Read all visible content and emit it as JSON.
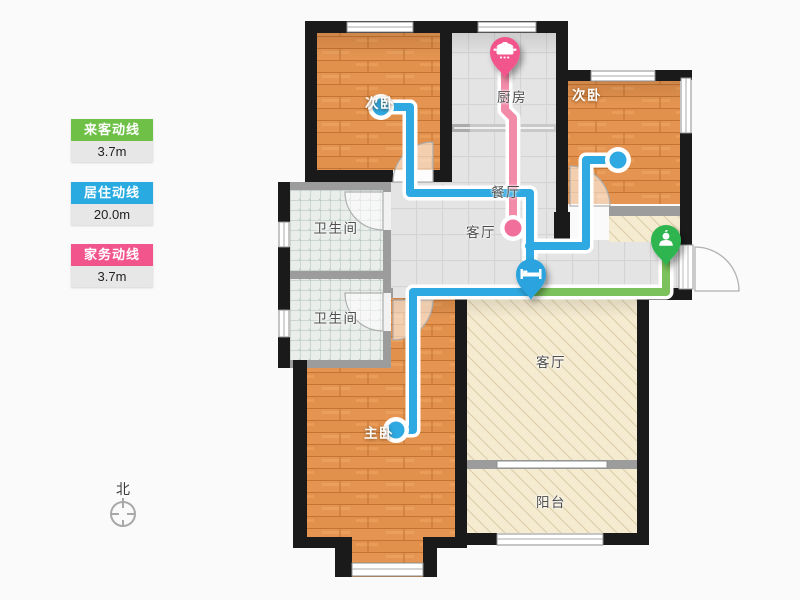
{
  "legend": {
    "items": [
      {
        "label": "来客动线",
        "value": "3.7m",
        "color": "#6EC047"
      },
      {
        "label": "居住动线",
        "value": "20.0m",
        "color": "#29ABE2"
      },
      {
        "label": "家务动线",
        "value": "3.7m",
        "color": "#F2548C"
      }
    ]
  },
  "compass": {
    "label": "北"
  },
  "floorplan": {
    "rooms": [
      {
        "name": "次卧"
      },
      {
        "name": "厨房"
      },
      {
        "name": "次卧"
      },
      {
        "name": "餐厅"
      },
      {
        "name": "客厅"
      },
      {
        "name": "卫生间"
      },
      {
        "name": "卫生间"
      },
      {
        "name": "主卧"
      },
      {
        "name": "客厅"
      },
      {
        "name": "阳台"
      }
    ],
    "lines": {
      "visitor": {
        "label": "来客动线",
        "length": "3.7m",
        "color": "#7BC25C"
      },
      "living": {
        "label": "居住动线",
        "length": "20.0m",
        "color": "#2FA9E1"
      },
      "housework": {
        "label": "家务动线",
        "length": "3.7m",
        "color": "#F28BA8"
      }
    },
    "pins": {
      "kitchen": {
        "icon": "pot-icon",
        "color": "#F2548C"
      },
      "bed": {
        "icon": "bed-icon",
        "color": "#29A3DF"
      },
      "visitor": {
        "icon": "person-icon",
        "color": "#2FB54F"
      }
    },
    "endpoint_colors": {
      "blue": "#2FA9E1",
      "pink": "#F16F9B"
    }
  },
  "colors": {
    "wall": "#1A1A1A",
    "partition": "#9C9C9C",
    "wood": "#E2914D",
    "tile": "#E4E4E4",
    "bath_tile": "#EAEEEB",
    "beige": "#F5EBD1",
    "background": "#FAFAFA"
  }
}
